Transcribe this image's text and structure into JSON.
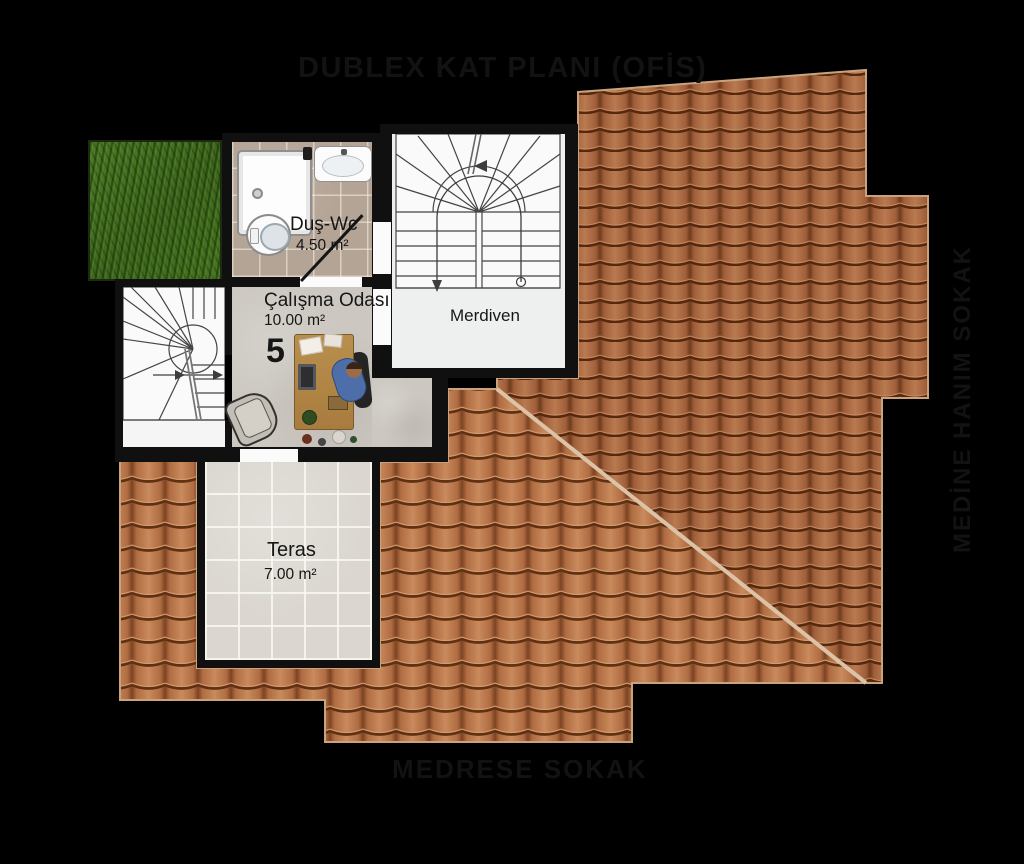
{
  "title": "DUBLEX KAT PLANI (OFİS)",
  "streets": {
    "bottom": "MEDRESE SOKAK",
    "right": "MEDİNE HANIM SOKAK"
  },
  "unit": {
    "number": "5"
  },
  "rooms": {
    "dus_wc": {
      "name": "Duş-Wc",
      "area": "4.50 m²"
    },
    "calisma_odasi": {
      "name": "Çalışma Odası",
      "area": "10.00 m²"
    },
    "merdiven": {
      "name": "Merdiven"
    },
    "teras": {
      "name": "Teras",
      "area": "7.00 m²"
    }
  },
  "colors": {
    "background": "#000000",
    "roof_lower_plane": "#b3744e",
    "roof_upper_plane": "#a2623e",
    "roof_ridge_trim": "#dcc3a8",
    "walls": "#101010",
    "grass": "#4a7522",
    "bathroom_floor": "#b4a496",
    "concrete_floor": "#ccc8c1",
    "terrace_floor": "#dbd7d0",
    "stair_floor": "#eef0ef",
    "label_text": "#161616"
  }
}
